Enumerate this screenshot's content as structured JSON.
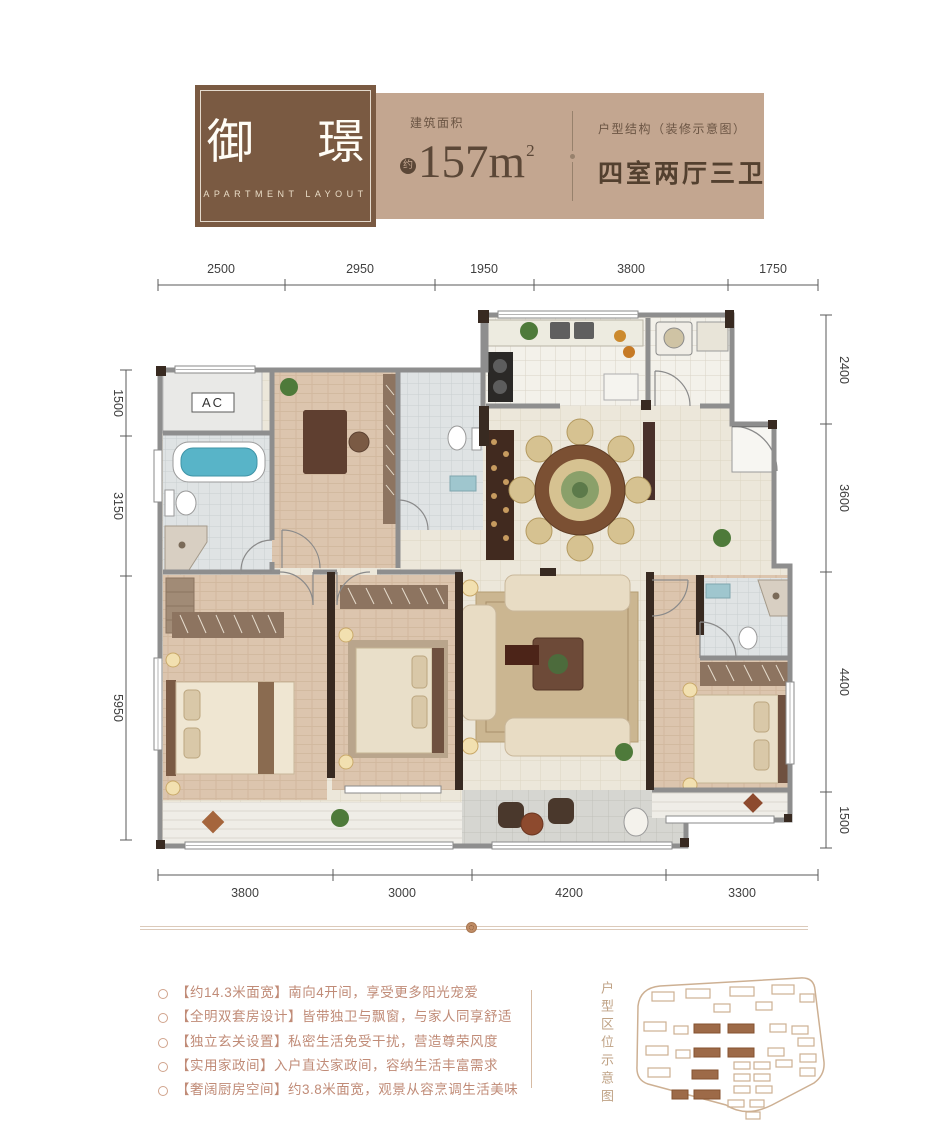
{
  "header": {
    "logo": {
      "title": "御 璟",
      "subtitle": "APARTMENT LAYOUT"
    },
    "area": {
      "label": "建筑面积",
      "approx_badge": "约",
      "value": "157m",
      "sup": "2"
    },
    "structure": {
      "label": "户型结构（装修示意图）",
      "value": "四室两厅三卫"
    }
  },
  "plan": {
    "ac_label": "AC",
    "dimensions": {
      "top": [
        "2500",
        "2950",
        "1950",
        "3800",
        "1750"
      ],
      "bottom": [
        "3800",
        "3000",
        "4200",
        "3300"
      ],
      "left": [
        "1500",
        "3150",
        "5950"
      ],
      "right": [
        "2400",
        "3600",
        "4400",
        "1500"
      ]
    }
  },
  "features": {
    "items": [
      "【约14.3米面宽】南向4开间，享受更多阳光宠爱",
      "【全明双套房设计】皆带独卫与飘窗，与家人同享舒适",
      "【独立玄关设置】私密生活免受干扰，营造尊荣风度",
      "【实用家政间】入户直达家政间，容纳生活丰富需求",
      "【奢阔厨房空间】约3.8米面宽，观景从容烹调生活美味"
    ]
  },
  "sitemap": {
    "label": "户型区位示意图"
  },
  "colors": {
    "brand_brown": "#7a5a42",
    "tan_panel": "#c3a690",
    "ink_brown": "#5b4737",
    "feature_text": "#c08b77",
    "wall_gray": "#8e8e8e",
    "wall_dark": "#382a21",
    "tub_teal": "#58b4c8",
    "site_building_fill": "#9d6a48"
  }
}
